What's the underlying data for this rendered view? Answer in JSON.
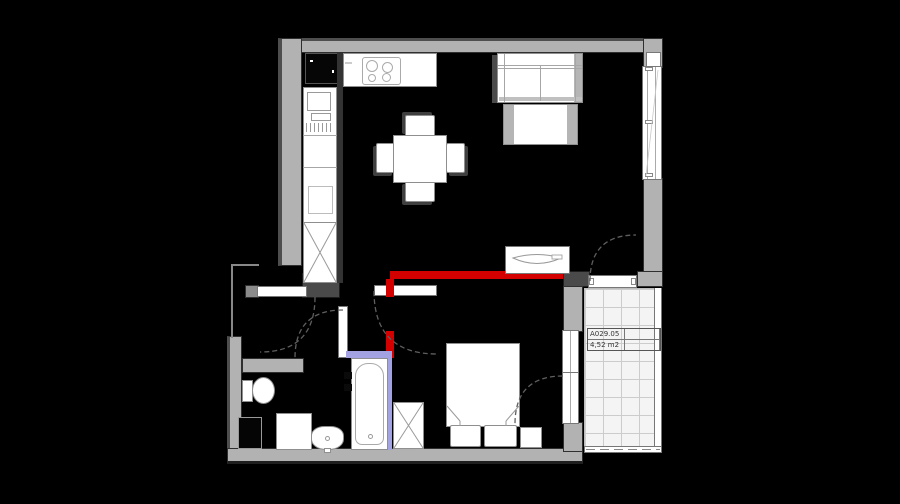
{
  "drawing": {
    "type": "architectural-floor-plan",
    "balcony_label": {
      "code": "A029.05",
      "area": "4,52 m2"
    }
  },
  "colors": {
    "floor": "#000000",
    "wall": "#b2b2b2",
    "wall_edge": "#2f2f2f",
    "fixture_fill": "#ffffff",
    "fixture_line": "#8f8f8f",
    "accent_red": "#d40000",
    "accent_lavender": "#a2a2e2",
    "tile_bg": "#f4f4f4",
    "tile_line": "#cccccc",
    "arc": "#5f5f5f"
  },
  "elements": [
    "fridge",
    "cooktop",
    "kitchen-counter",
    "kitchen-cabinets",
    "tall-cabinet",
    "dining-table",
    "chairs",
    "sofa",
    "coffee-table",
    "tv-console",
    "window",
    "balcony",
    "balcony-railing",
    "bed",
    "pillows",
    "nightstand",
    "wardrobe",
    "bathtub",
    "toilet",
    "washing-machine",
    "wash-basin",
    "vanity-cabinet",
    "door-leafs",
    "door-swing-arcs"
  ]
}
